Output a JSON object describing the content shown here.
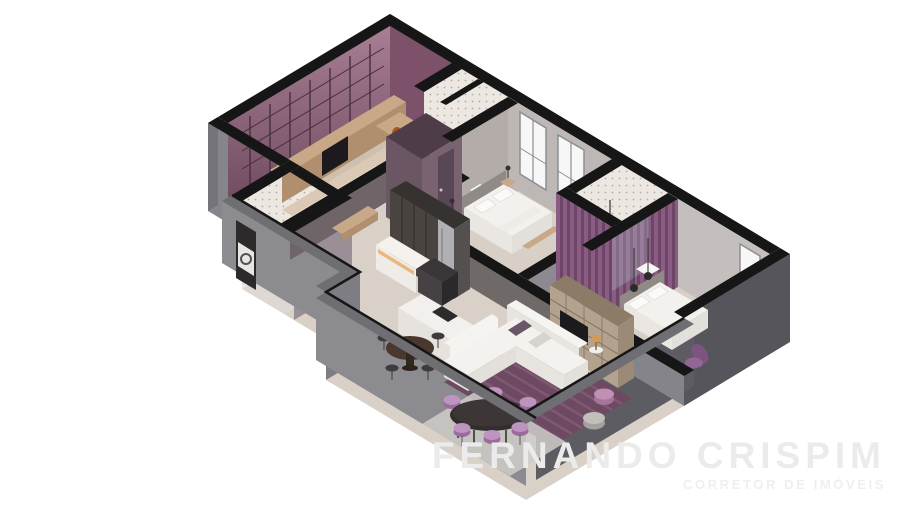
{
  "watermark": {
    "line1": "FERNANDO CRISPIM",
    "line2": "CORRETOR DE IMÓVEIS"
  },
  "scene": {
    "type": "isometric-3d-floor-plan",
    "rooms": [
      "home-office",
      "hall-bathroom",
      "shower-bathroom",
      "laundry-room",
      "bedroom",
      "ensuite-bathroom",
      "master-bedroom",
      "hallway",
      "kitchen",
      "dining-area",
      "living-room"
    ]
  },
  "palette": {
    "bg": "#ffffff",
    "wallCut": "#161616",
    "grayBandTop": "#6e6e73",
    "extGrayLight": "#8b8b90",
    "extGrayMid": "#85858a",
    "extGrayDark": "#5c5c62",
    "extGrayDarker": "#55555b",
    "capGray": "#74747a",
    "corridorWall": "#6f6568",
    "kitchenBackWall": "#6f6a68",
    "lowWallGray": "#84848a",
    "jogWall": "#7d7d83",
    "bedroom1NWWall": "#b3aca9",
    "windowsWall": "#bdb8b5",
    "bedroom2NEWall": "#c4bfbc",
    "officePink": "#a87e95",
    "officePinkDark": "#6e4a5e",
    "officeSideWall": "#7c5169",
    "shelfLine": "#46303c",
    "tileBase": "#ece7e1",
    "tileDot": "#8a7878",
    "tileFloor": "#e7e3de",
    "floorOffice": "#cfbfae",
    "floorBeige": "#d8d0c6",
    "floorWarm": "#d9d1c8",
    "floorLaundry": "#ddd8d3",
    "rugOffice": "#dac9b4",
    "slat": "#8a5c83",
    "slatDark": "#6d4566",
    "plumFaceSW": "#6b5663",
    "plumFaceSE": "#7a6370",
    "plumTop": "#4e3d48",
    "plumDoor": "#5a4755",
    "bedWhite": "#f3f1ee",
    "bedShadow": "#e3e0db",
    "bedSide": "#eae7e3",
    "pillow": "#fbfaf8",
    "headboard": "#8f8a85",
    "woodTan": "#c9a887",
    "woodMid": "#b08f6e",
    "woodDark": "#4a382e",
    "orange": "#c2692f",
    "orangeDark": "#a85420",
    "cabinet": "#49443f",
    "cabinetTop": "#353230",
    "cabinetSide": "#555050",
    "steel": "#b0b0b4",
    "counter": "#efece7",
    "counterTop": "#f5f2ee",
    "glow": "#e9ad6d",
    "island": "#f2efec",
    "islandSW": "#e6e2de",
    "islandSE": "#dcd8d4",
    "cooktop": "#2d2b2d",
    "hoodTop": "#3a3638",
    "hoodSW": "#464244",
    "hoodSE": "#2b292b",
    "tvTan": "#b3a28d",
    "tvTop": "#8b7b67",
    "tvSide": "#9b8a76",
    "tvShelf": "#8a7a66",
    "tvScreen": "#1c1a1c",
    "rugPurple": "#6e4a62",
    "rugStripe": "#86607a",
    "rugGrayDining": "#cfccc9",
    "tableBlack": "#332e2e",
    "chairPurple": "#9c6b9e",
    "chairPurpleLight": "#bd93bf",
    "poufPink": "#c18fb4",
    "poufPinkDark": "#a9749c",
    "poufGray": "#c2beba",
    "poufGrayDark": "#a5a19e",
    "sofaTop": "#f4f2ef",
    "sofaSide": "#e8e5e1",
    "sofaEnd": "#e3e0db",
    "sofaBack": "#f6f4f1",
    "chairDark": "#3d3b3e",
    "windowWhite": "#f7f7f7",
    "windowFrame": "#8d8d92",
    "metal": "#666666",
    "lampGold": "#d99a4e",
    "watermark1": "#ebebeb",
    "watermark2": "#efefef"
  }
}
